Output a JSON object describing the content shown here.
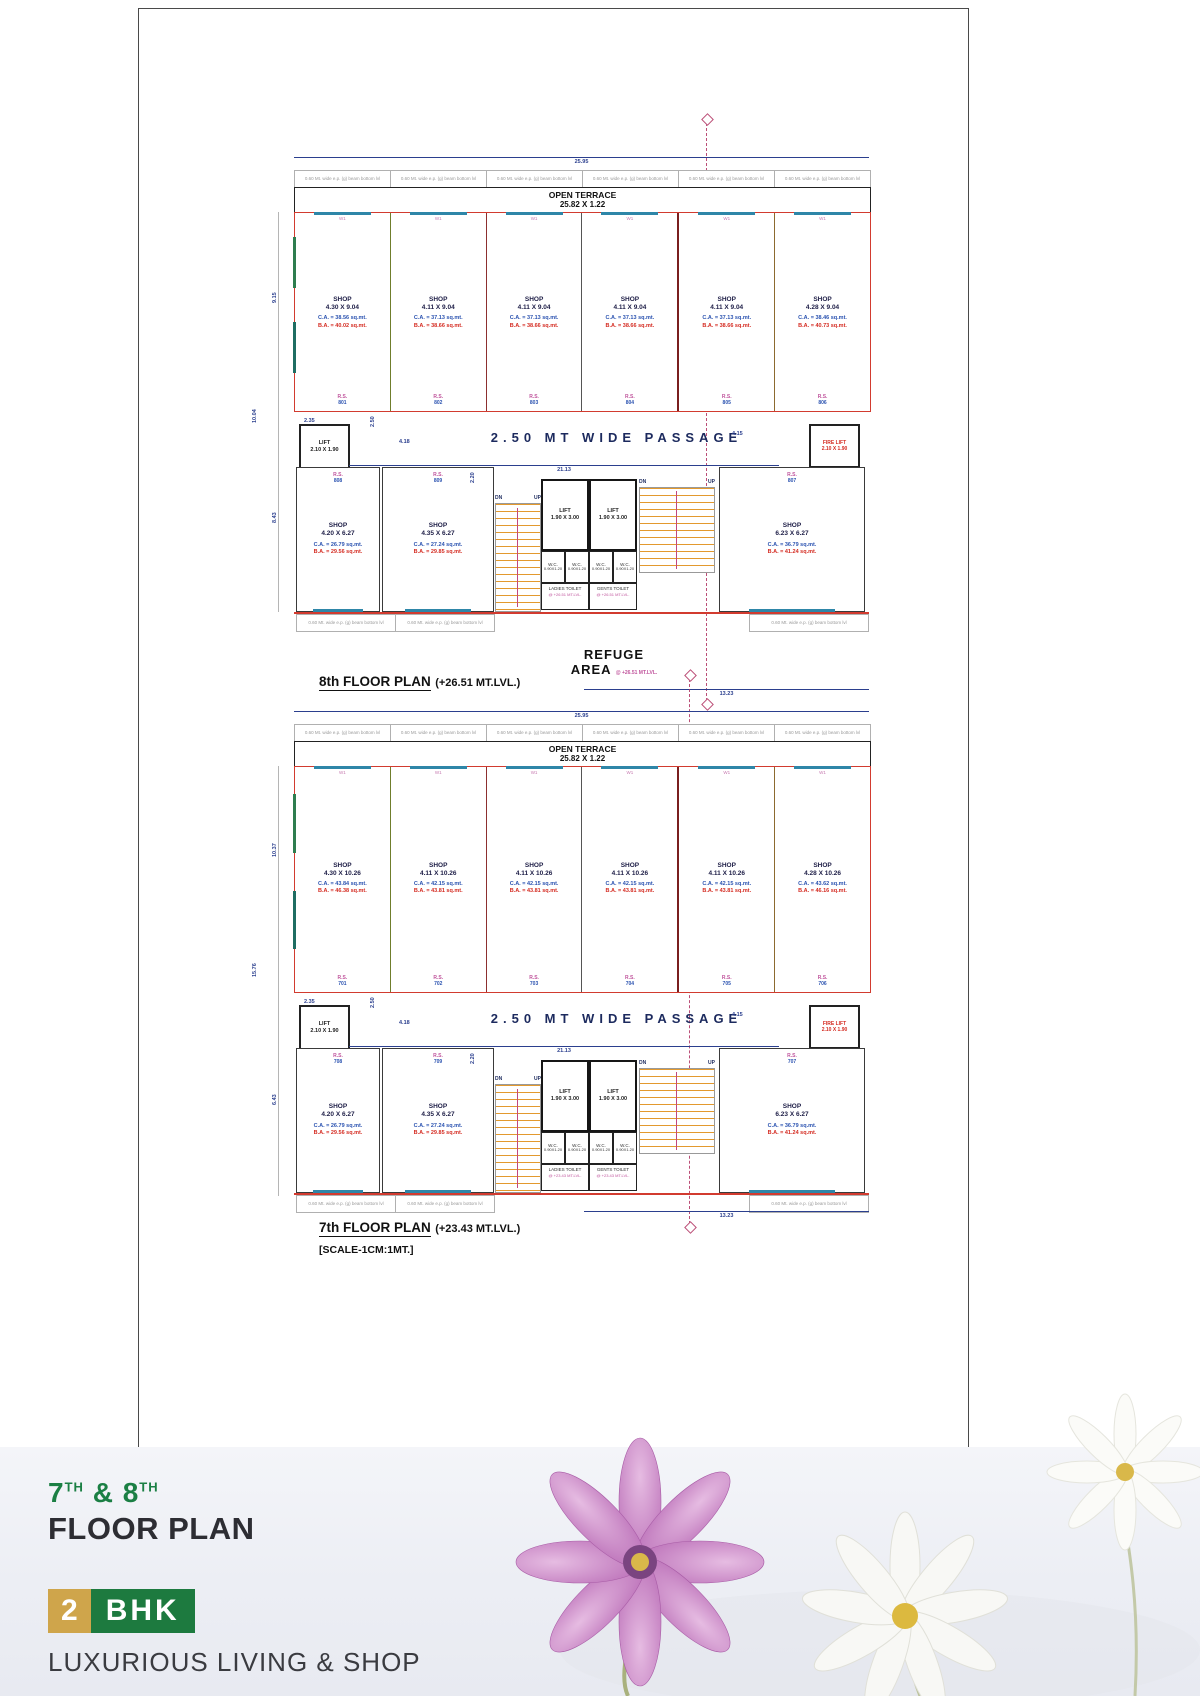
{
  "colors": {
    "line_red": "#d23b2f",
    "dim_blue": "#2b3f8e",
    "carpet_area_blue": "#2a52b0",
    "builtup_area_red": "#d42a20",
    "rs_pink": "#c0549c",
    "stair_orange": "#e3992e",
    "centerline_magenta": "#b03060",
    "footer_green": "#1b7f44",
    "footer_gold": "#cfa54b"
  },
  "plan8": {
    "title": "8th FLOOR PLAN",
    "title_level": "(+26.51 MT.LVL.)",
    "terrace_label": "OPEN TERRACE",
    "terrace_dim": "25.82 X 1.22",
    "beam_note": "0.60 Mt. wide e.p. (g) beam bottom lvl",
    "window_tag": "W1",
    "passage_label": "2.50 MT WIDE PASSAGE",
    "lift_label": "LIFT",
    "lift_dim": "2.10 X 1.90",
    "fire_lift_label": "FIRE LIFT",
    "fire_lift_dim": "2.10 X 1.90",
    "core_lift_dim": "1.90 X 3.00",
    "wc_label": "W.C.",
    "wc_dim": "0.90X1.20",
    "ladies_toilet": "LADIES TOILET",
    "gents_toilet": "GENTS TOILET",
    "toilet_level": "@ +26.51 MT.LVL.",
    "refuge_line1": "REFUGE",
    "refuge_line2": "AREA",
    "refuge_level": "@ +26.51 MT.LVL.",
    "dn": "DN",
    "up": "UP",
    "shops_top": [
      {
        "label": "SHOP",
        "dim": "4.30 X 9.04",
        "ca": "C.A. = 38.56 sq.mt.",
        "ba": "B.A. = 40.02 sq.mt.",
        "rs": "R.S.",
        "no": "801"
      },
      {
        "label": "SHOP",
        "dim": "4.11 X 9.04",
        "ca": "C.A. = 37.13 sq.mt.",
        "ba": "B.A. = 38.66 sq.mt.",
        "rs": "R.S.",
        "no": "802"
      },
      {
        "label": "SHOP",
        "dim": "4.11 X 9.04",
        "ca": "C.A. = 37.13 sq.mt.",
        "ba": "B.A. = 38.66 sq.mt.",
        "rs": "R.S.",
        "no": "803"
      },
      {
        "label": "SHOP",
        "dim": "4.11 X 9.04",
        "ca": "C.A. = 37.13 sq.mt.",
        "ba": "B.A. = 38.66 sq.mt.",
        "rs": "R.S.",
        "no": "804"
      },
      {
        "label": "SHOP",
        "dim": "4.11 X 9.04",
        "ca": "C.A. = 37.13 sq.mt.",
        "ba": "B.A. = 38.66 sq.mt.",
        "rs": "R.S.",
        "no": "805"
      },
      {
        "label": "SHOP",
        "dim": "4.28 X 9.04",
        "ca": "C.A. = 38.46 sq.mt.",
        "ba": "B.A. = 40.73 sq.mt.",
        "rs": "R.S.",
        "no": "806"
      }
    ],
    "shops_bottom": [
      {
        "label": "SHOP",
        "dim": "4.20 X 6.27",
        "ca": "C.A. = 26.79 sq.mt.",
        "ba": "B.A. = 29.56 sq.mt.",
        "rs": "R.S.",
        "no": "808"
      },
      {
        "label": "SHOP",
        "dim": "4.35 X 6.27",
        "ca": "C.A. = 27.24 sq.mt.",
        "ba": "B.A. = 29.85 sq.mt.",
        "rs": "R.S.",
        "no": "809"
      },
      {
        "label": "SHOP",
        "dim": "6.23 X 6.27",
        "ca": "C.A. = 36.79 sq.mt.",
        "ba": "B.A. = 41.24 sq.mt.",
        "rs": "R.S.",
        "no": "807"
      }
    ],
    "dims": {
      "top": "25.95",
      "left_upper": "9.15",
      "left_lower": "8.43",
      "left_outer": "10.04",
      "passage_len": "21.13",
      "passage_width": "2.50",
      "seg_a": "4.18",
      "lift_w": "2.35",
      "right_b": "4.15",
      "stair": "2.20",
      "bottom": "13.23"
    }
  },
  "plan7": {
    "title": "7th FLOOR PLAN",
    "title_level": "(+23.43 MT.LVL.)",
    "terrace_label": "OPEN TERRACE",
    "terrace_dim": "25.82 X 1.22",
    "beam_note": "0.60 Mt. wide e.p. (g) beam bottom lvl",
    "window_tag": "W1",
    "passage_label": "2.50 MT WIDE PASSAGE",
    "lift_label": "LIFT",
    "lift_dim": "2.10 X 1.90",
    "fire_lift_label": "FIRE LIFT",
    "fire_lift_dim": "2.10 X 1.90",
    "core_lift_dim": "1.90 X 3.00",
    "wc_label": "W.C.",
    "wc_dim": "0.90X1.20",
    "ladies_toilet": "LADIES TOILET",
    "gents_toilet": "GENTS TOILET",
    "toilet_level": "@ +23.43 MT.LVL.",
    "dn": "DN",
    "up": "UP",
    "shops_top": [
      {
        "label": "SHOP",
        "dim": "4.30 X 10.26",
        "ca": "C.A. = 43.84 sq.mt.",
        "ba": "B.A. = 46.38 sq.mt.",
        "rs": "R.S.",
        "no": "701"
      },
      {
        "label": "SHOP",
        "dim": "4.11 X 10.26",
        "ca": "C.A. = 42.15 sq.mt.",
        "ba": "B.A. = 43.81 sq.mt.",
        "rs": "R.S.",
        "no": "702"
      },
      {
        "label": "SHOP",
        "dim": "4.11 X 10.26",
        "ca": "C.A. = 42.15 sq.mt.",
        "ba": "B.A. = 43.81 sq.mt.",
        "rs": "R.S.",
        "no": "703"
      },
      {
        "label": "SHOP",
        "dim": "4.11 X 10.26",
        "ca": "C.A. = 42.15 sq.mt.",
        "ba": "B.A. = 43.81 sq.mt.",
        "rs": "R.S.",
        "no": "704"
      },
      {
        "label": "SHOP",
        "dim": "4.11 X 10.26",
        "ca": "C.A. = 42.15 sq.mt.",
        "ba": "B.A. = 43.81 sq.mt.",
        "rs": "R.S.",
        "no": "705"
      },
      {
        "label": "SHOP",
        "dim": "4.28 X 10.26",
        "ca": "C.A. = 43.62 sq.mt.",
        "ba": "B.A. = 46.16 sq.mt.",
        "rs": "R.S.",
        "no": "706"
      }
    ],
    "shops_bottom": [
      {
        "label": "SHOP",
        "dim": "4.20 X 6.27",
        "ca": "C.A. = 26.79 sq.mt.",
        "ba": "B.A. = 29.56 sq.mt.",
        "rs": "R.S.",
        "no": "708"
      },
      {
        "label": "SHOP",
        "dim": "4.35 X 6.27",
        "ca": "C.A. = 27.24 sq.mt.",
        "ba": "B.A. = 29.85 sq.mt.",
        "rs": "R.S.",
        "no": "709"
      },
      {
        "label": "SHOP",
        "dim": "6.23 X 6.27",
        "ca": "C.A. = 36.79 sq.mt.",
        "ba": "B.A. = 41.24 sq.mt.",
        "rs": "R.S.",
        "no": "707"
      }
    ],
    "dims": {
      "top": "25.95",
      "left_upper": "10.37",
      "left_lower": "6.43",
      "left_outer": "15.76",
      "passage_len": "21.13",
      "passage_width": "2.50",
      "seg_a": "4.18",
      "lift_w": "2.35",
      "right_b": "4.15",
      "stair": "2.20",
      "bottom": "13.23"
    }
  },
  "scale_note": "[SCALE-1CM:1MT.]",
  "footer": {
    "floor_a": "7",
    "floor_a_sup": "TH",
    "ampersand": "&",
    "floor_b": "8",
    "floor_b_sup": "TH",
    "heading": "FLOOR PLAN",
    "badge_num": "2",
    "badge_text": "BHK",
    "tagline": "LUXURIOUS  LIVING & SHOP"
  }
}
